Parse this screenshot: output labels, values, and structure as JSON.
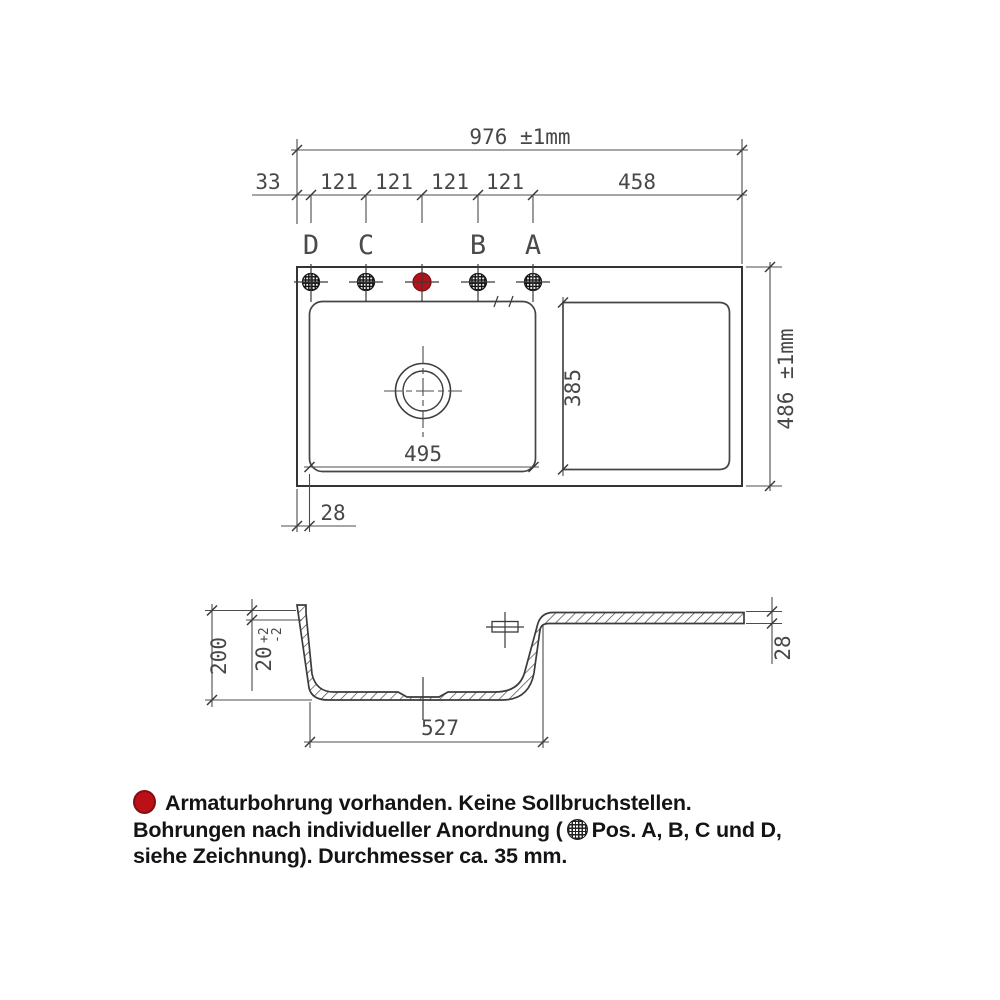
{
  "drawing": {
    "kind": "sink-dimension-drawing",
    "line_color": "#3b3b3b",
    "accent_red": "#bb1016"
  },
  "plan": {
    "overall_width": "976 ±1mm",
    "overall_depth": "486 ±1mm",
    "chain": [
      "33",
      "121",
      "121",
      "121",
      "121",
      "458"
    ],
    "hole_labels": [
      "D",
      "C",
      "B",
      "A"
    ],
    "basin_width": "495",
    "drainer_length": "385",
    "rim_offset": "28"
  },
  "section": {
    "depth": "200",
    "rim_height": "20",
    "rim_tol_plus": "+2",
    "rim_tol_minus": "-2",
    "basin_bottom_width": "527",
    "deck_thickness": "28"
  },
  "legend": {
    "line1": "Armaturbohrung vorhanden. Keine Sollbruchstellen.",
    "line2_before_icon": "Bohrungen nach individueller Anordnung (",
    "line2_after_icon": "Pos. A, B, C und D,",
    "line3": "siehe Zeichnung). Durchmesser ca. 35 mm."
  }
}
